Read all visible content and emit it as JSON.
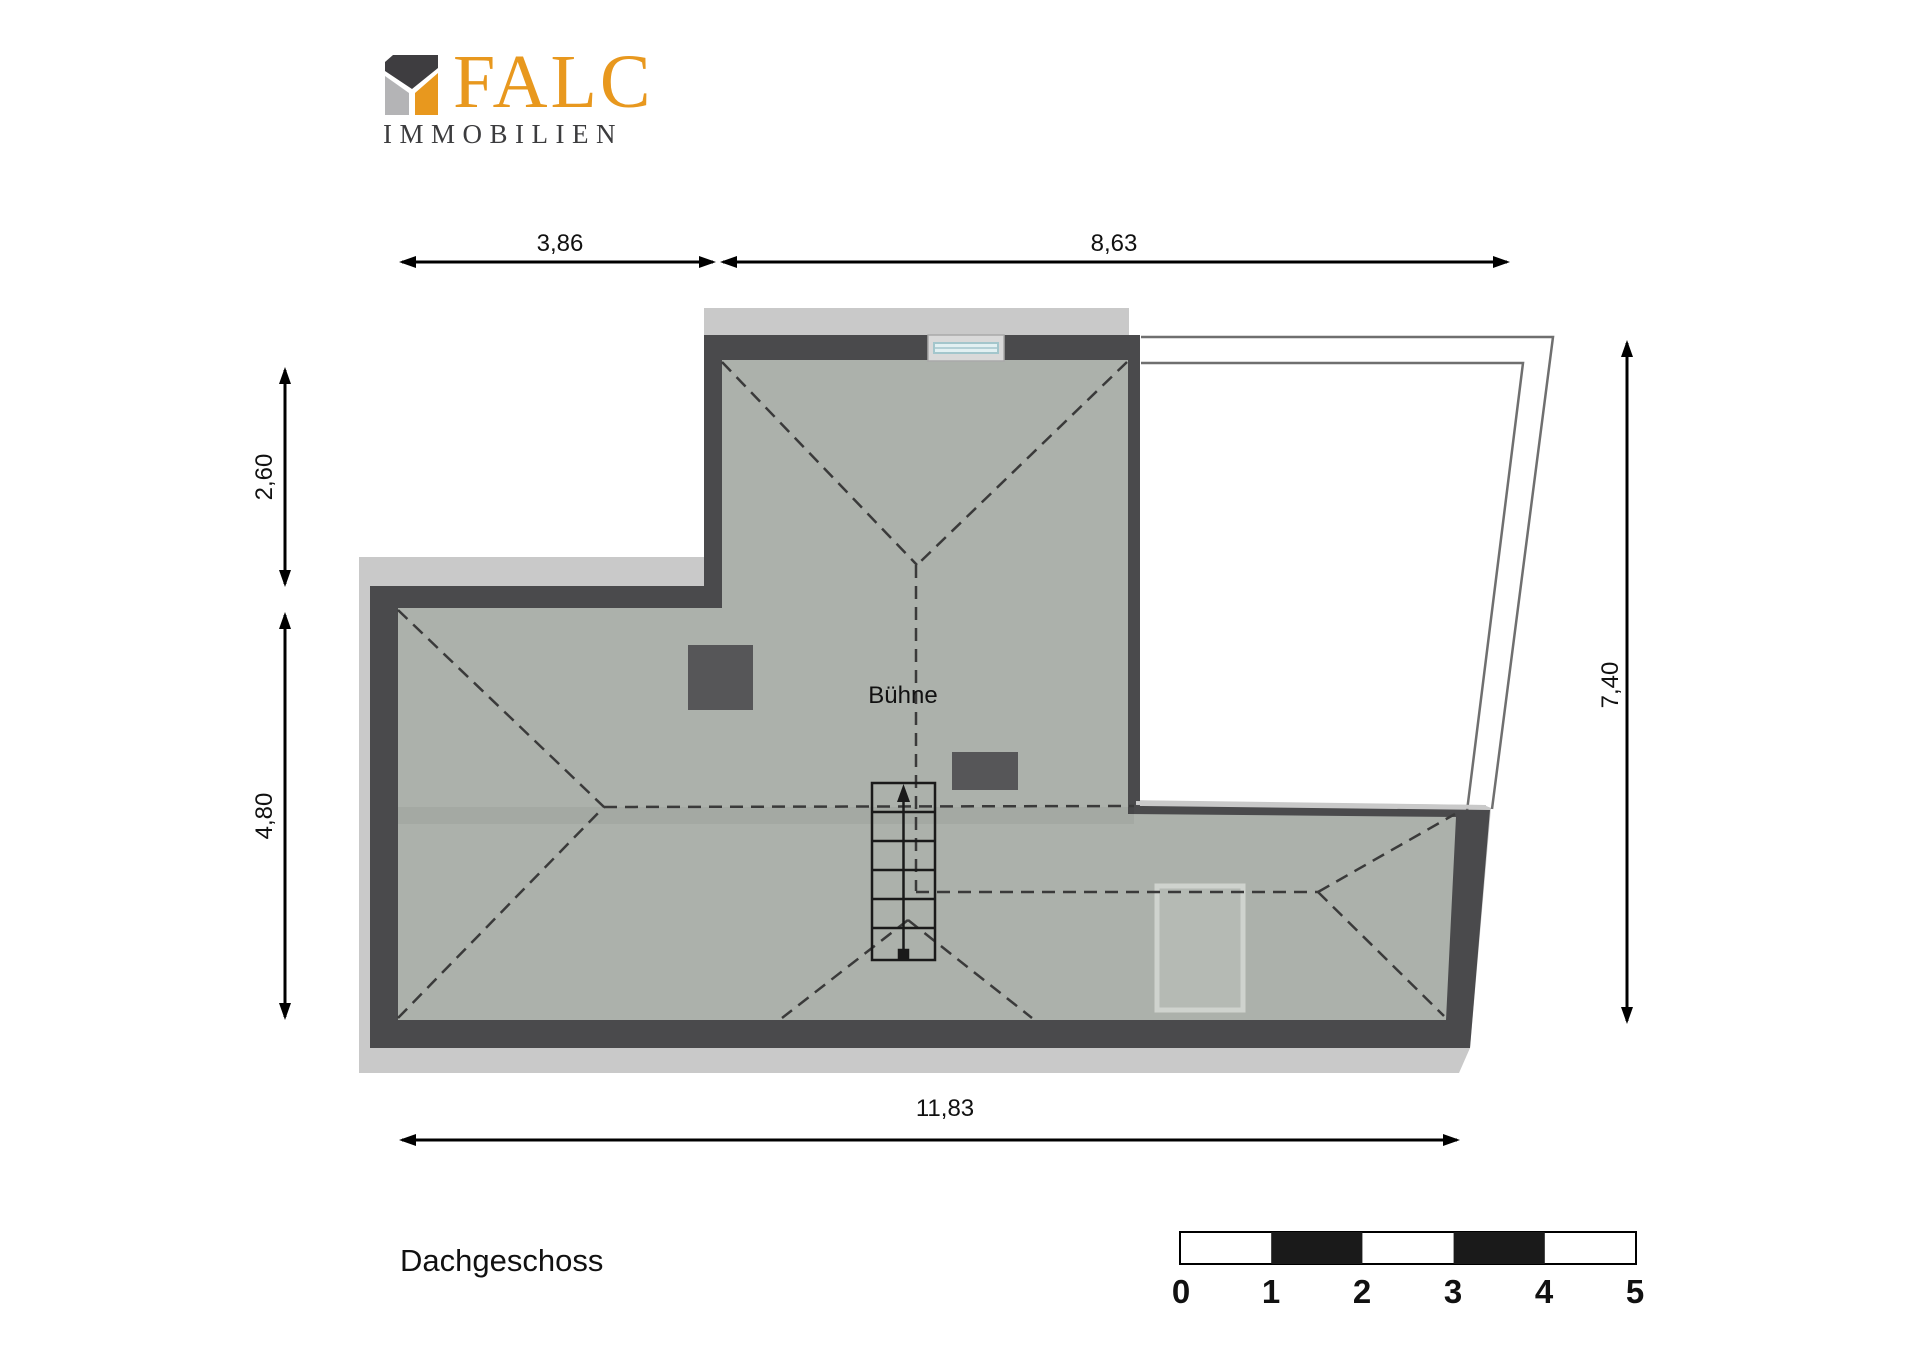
{
  "logo": {
    "brand": "FALC",
    "subtitle": "IMMOBILIEN",
    "orange": "#E8981E",
    "dark": "#3E3D40",
    "gray": "#B4B4B6"
  },
  "plan": {
    "room_label": "Bühne",
    "floor_label": "Dachgeschoss",
    "dimensions": {
      "top_left": "3,86",
      "top_right": "8,63",
      "left_upper": "2,60",
      "left_lower": "4,80",
      "right": "7,40",
      "bottom": "11,83"
    },
    "colors": {
      "room": "#ACB1AB",
      "wall": "#4A4A4C",
      "shadow": "#C9C9C9",
      "chimney": "#565658",
      "outline": "#6F6F6F"
    }
  },
  "scale_bar": {
    "labels": [
      "0",
      "1",
      "2",
      "3",
      "4",
      "5"
    ]
  }
}
